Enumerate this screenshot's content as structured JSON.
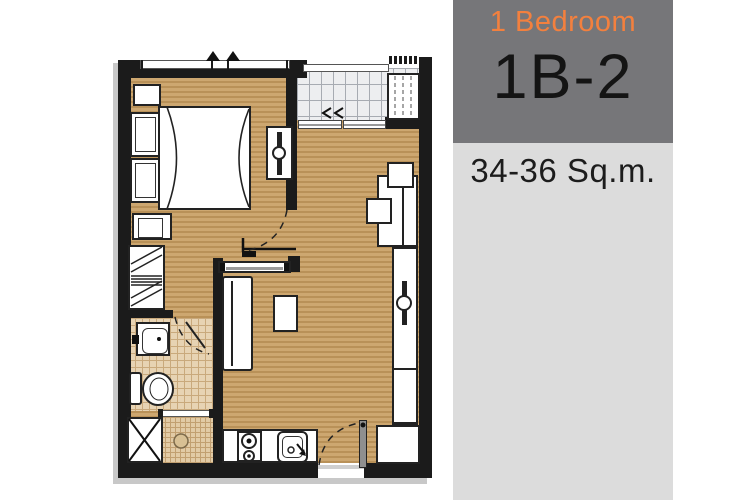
{
  "panel": {
    "category": "1 Bedroom",
    "unit_code": "1B-2",
    "area": "34-36 Sq.m."
  },
  "colors": {
    "accent_orange": "#F3803E",
    "panel_dark_gray": "#767679",
    "panel_light_gray": "#DCDCDC",
    "wall_black": "#1B1B1B",
    "wood_floor_light": "#CDA770",
    "wood_floor_dark": "#B99158",
    "balcony_tile": "#EDEEF0",
    "bathroom_tile": "#E7D3B3",
    "unit_text": "#141414"
  }
}
